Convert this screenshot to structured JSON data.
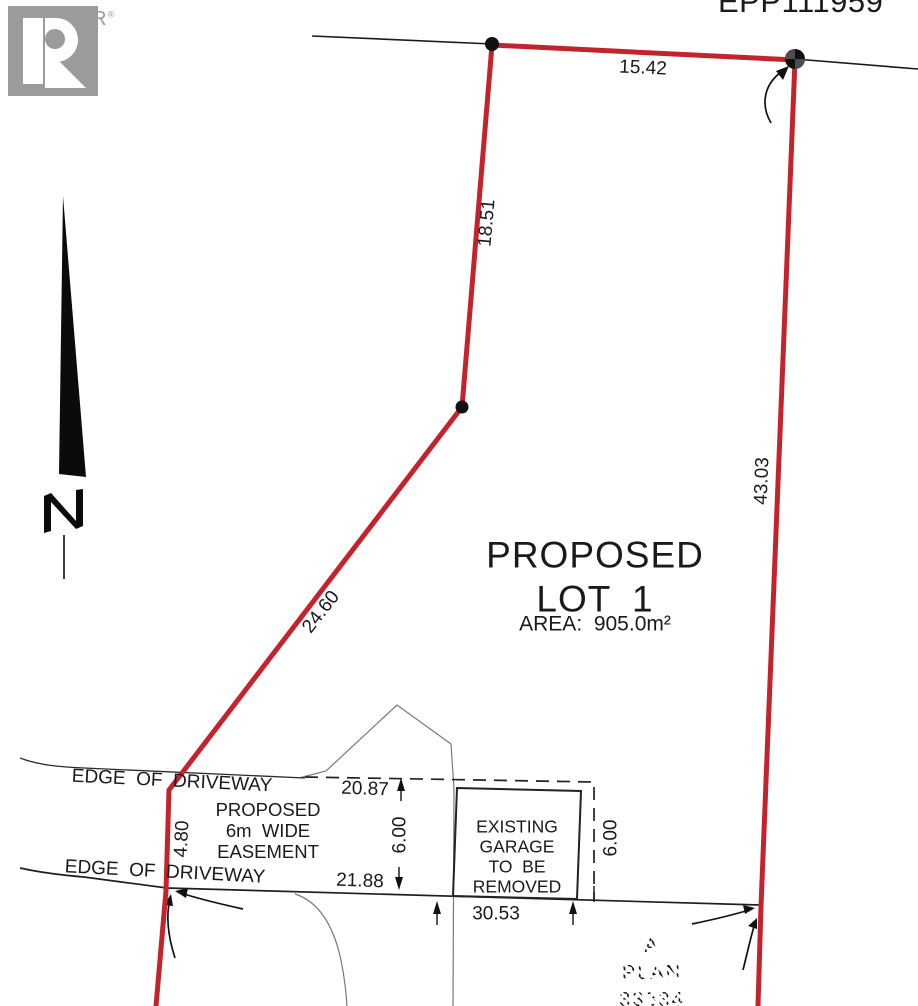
{
  "branding": {
    "logo_letter": "R",
    "logo_text": "REALTOR",
    "logo_reg": "®"
  },
  "plan": {
    "reference": "EPP111959",
    "lot": {
      "title_line1": "PROPOSED",
      "title_line2": "LOT 1",
      "area": "AREA:  905.0m²"
    },
    "dimensions": {
      "top": "15.42",
      "upper_left": "18.51",
      "right": "43.03",
      "diagonal": "24.60",
      "lower_left": "4.80",
      "easement_top": "20.87",
      "easement_width_left": "6.00",
      "easement_bottom": "21.88",
      "easement_width_right": "6.00",
      "road": "30.53"
    },
    "easement_label": {
      "line1": "PROPOSED",
      "line2": "6m  WIDE",
      "line3": "EASEMENT"
    },
    "garage_label": {
      "line1": "EXISTING",
      "line2": "GARAGE",
      "line3": "TO  BE",
      "line4": "REMOVED"
    },
    "driveway_label_top": "EDGE  OF  DRIVEWAY",
    "driveway_label_bottom": "EDGE  OF  DRIVEWAY",
    "adjacent_lot": {
      "line1": "A",
      "line2": "PLAN",
      "line3": "33334"
    }
  },
  "colors": {
    "boundary_red": "#c5232b",
    "line_black": "#1a1a1a",
    "thin_gray": "#7a7a7a",
    "logo_gray": "#9b9b9b"
  }
}
